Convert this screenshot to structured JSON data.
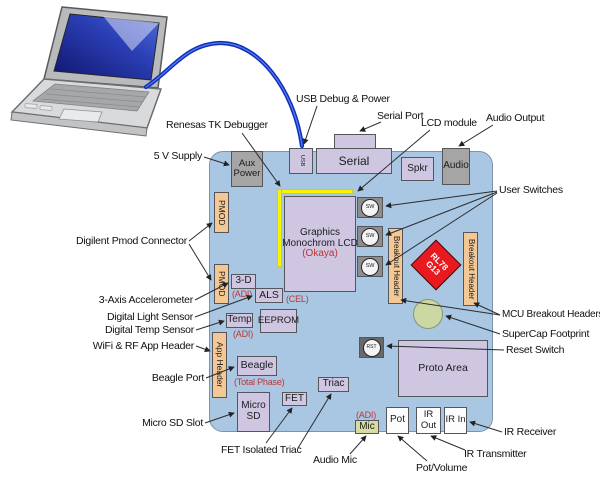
{
  "callouts": {
    "supply_5v": "5 V Supply",
    "renesas_tk": "Renesas TK Debugger",
    "usb_debug": "USB Debug & Power",
    "serial_port": "Serial Port",
    "lcd_module": "LCD module",
    "audio_output": "Audio Output",
    "user_switches": "User Switches",
    "mcu_breakout": "MCU Breakout Headers",
    "supercap": "SuperCap Footprint",
    "reset_switch": "Reset Switch",
    "ir_receiver": "IR Receiver",
    "ir_transmitter": "IR Transmitter",
    "pot_volume": "Pot/Volume",
    "audio_mic": "Audio Mic",
    "fet_triac": "FET Isolated Triac",
    "micro_sd_slot": "Micro SD Slot",
    "beagle_port": "Beagle Port",
    "wifi_rf": "WiFi & RF App Header",
    "digital_temp": "Digital Temp Sensor",
    "digital_light": "Digital Light Sensor",
    "accelerometer": "3-Axis Accelerometer",
    "pmod_connector": "Digilent Pmod Connector"
  },
  "board": {
    "aux_power": "Aux Power",
    "usb": "USB",
    "serial": "Serial",
    "spkr": "Spkr",
    "audio": "Audio",
    "sw": "SW",
    "pmod": "PMOD",
    "lcd_line1": "Graphics",
    "lcd_line2": "Monochrom LCD",
    "lcd_sub": "(Okaya)",
    "breakout_header": "Breakout Header",
    "mcu_line1": "RL78",
    "mcu_line2": "G13",
    "d3": "3-D",
    "adi": "(ADI)",
    "als": "ALS",
    "cel": "(CEL)",
    "temp": "Temp",
    "eeprom": "EEPROM",
    "app_header": "App Header",
    "beagle": "Beagle",
    "total_phase": "(Total Phase)",
    "micro_sd": "Micro SD",
    "fet": "FET",
    "triac": "Triac",
    "rst": "RST",
    "proto_area": "Proto Area",
    "mic": "Mic",
    "pot": "Pot",
    "ir_out": "IR Out",
    "ir_in": "IR In"
  },
  "colors": {
    "board_blue": "#a9c7e2",
    "component_lavender": "#cfc6e2",
    "header_tan": "#f3c894",
    "connector_gray": "#a5a5a6",
    "mcu_red": "#e8191f",
    "debug_yellow": "#f8f504",
    "annotation_red": "#c03434",
    "cable_blue": "#0b2fbe",
    "supercap_green": "#ccd8a2",
    "mic_olive": "#d9dc9f"
  }
}
